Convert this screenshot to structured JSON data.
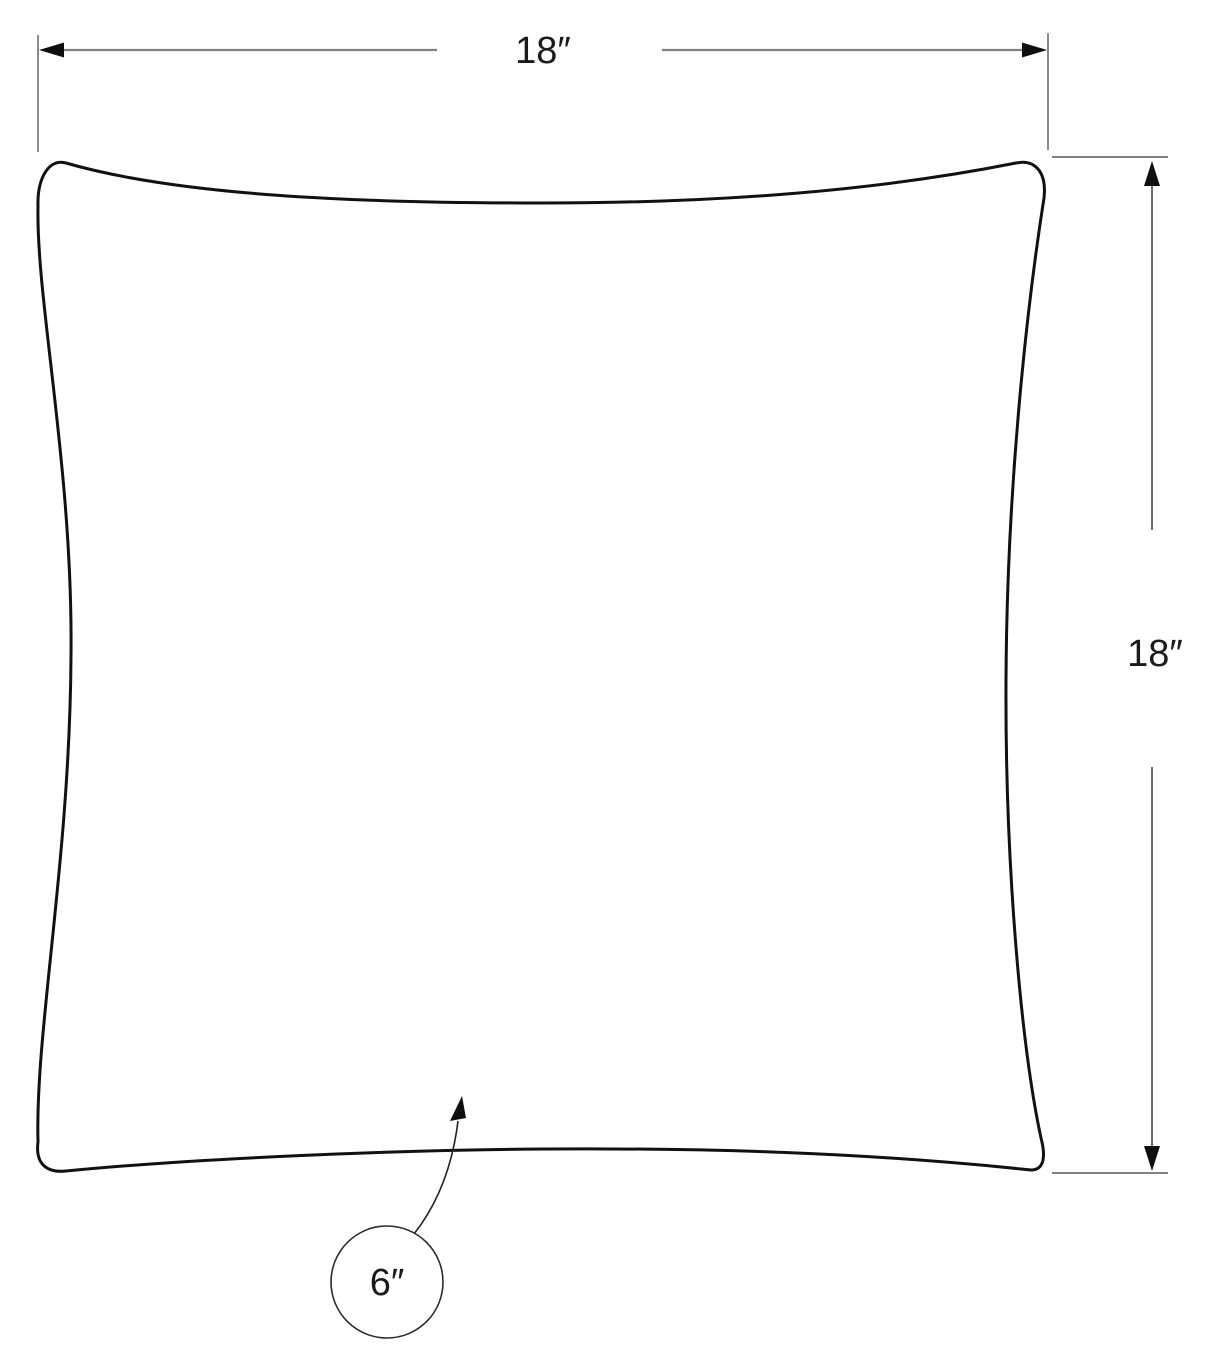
{
  "diagram": {
    "labels": {
      "top_width": "18″",
      "right_height": "18″",
      "callout": "6″"
    },
    "measurements": {
      "width_inches": 18,
      "height_inches": 18,
      "callout_inches": 6
    }
  },
  "icons": {
    "width_arrow_left": "filled-triangle-pointing-left",
    "width_arrow_right": "filled-triangle-pointing-right",
    "height_arrow_up": "filled-triangle-pointing-up",
    "height_arrow_down": "filled-triangle-pointing-down",
    "callout_leader_arrow": "curved-leader-with-filled-triangle-pointing-up"
  },
  "colors": {
    "background": "#ffffff",
    "pillow_outline": "#111111",
    "dimension_line": "#808080",
    "extension_line_vertical": "#595959",
    "extension_line_horizontal": "#808080",
    "height_dimension_line": "#444444",
    "arrowhead": "#0f0f0f",
    "label_text": "#1a1a1a",
    "callout_circle": "#2b2b2b",
    "leader_line": "#222222"
  }
}
